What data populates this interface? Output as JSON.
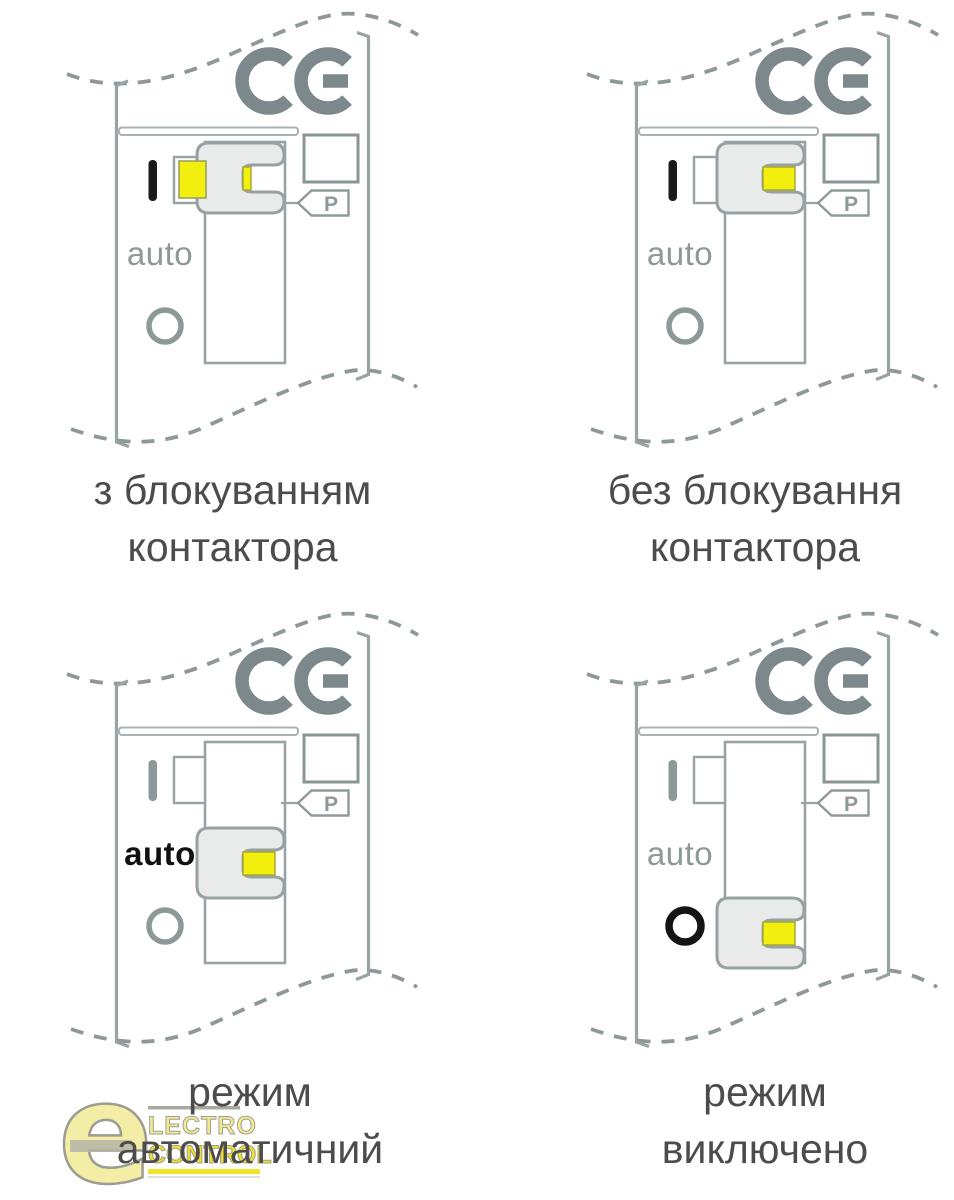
{
  "markings": {
    "on": "I",
    "auto": "auto",
    "off": "O",
    "parameter_tag": "P",
    "ce_mark": "CE"
  },
  "panels": [
    {
      "caption_line1": "з блокуванням",
      "caption_line2": "контактора",
      "slider_position": "up",
      "lock_tab": "extended",
      "active_marking": "on"
    },
    {
      "caption_line1": "без блокування",
      "caption_line2": "контактора",
      "slider_position": "up",
      "lock_tab": "retracted",
      "active_marking": "on"
    },
    {
      "caption_line1": "режим",
      "caption_line2": "автоматичний",
      "slider_position": "middle",
      "lock_tab": "retracted",
      "active_marking": "auto"
    },
    {
      "caption_line1": "режим",
      "caption_line2": "виключено",
      "slider_position": "down",
      "lock_tab": "retracted",
      "active_marking": "off"
    }
  ],
  "watermark": {
    "letter": "e",
    "line1": "LECTRO",
    "line2": "CONTROL"
  },
  "colors": {
    "line_gray": "#9aa3a3",
    "ce_gray": "#7c888b",
    "marking_gray": "#8d9898",
    "marking_black": "#1a1a1a",
    "yellow": "#f2ee0e",
    "slider_fill": "#e8ebe9",
    "caption_text": "#4c4c4c",
    "logo_yellow_light": "#f3eda6",
    "logo_yellow": "#f2df2e",
    "logo_outline": "#a09f95"
  }
}
